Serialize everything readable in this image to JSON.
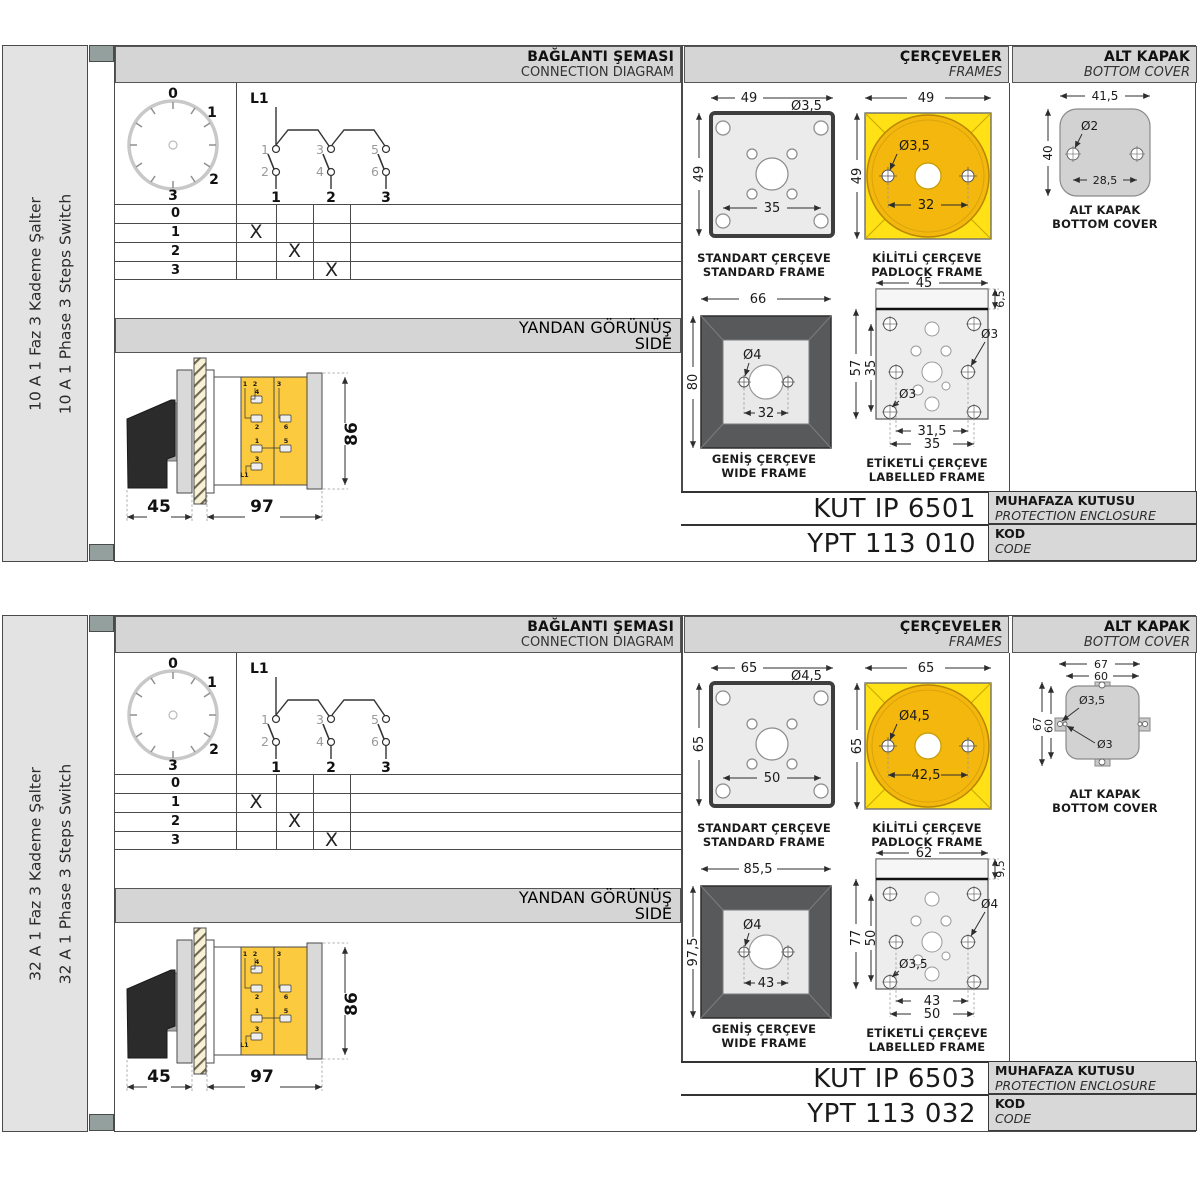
{
  "products": [
    {
      "sidebar": {
        "label_tr": "10 A 1 Faz 3 Kademe Şalter",
        "label_en": "10 A 1 Phase 3 Steps Switch"
      },
      "headers": {
        "connection_tr": "BAĞLANTI ŞEMASI",
        "connection_en": "CONNECTION DIAGRAM",
        "frames_tr": "ÇERÇEVELER",
        "frames_en": "FRAMES",
        "cover_tr": "ALT KAPAK",
        "cover_en": "BOTTOM COVER",
        "side_tr": "YANDAN GÖRÜNÜŞ",
        "side_en": "SIDE"
      },
      "dial": {
        "p0": "0",
        "p1": "1",
        "p2": "2",
        "p3": "3"
      },
      "schematic": {
        "feed": "L1",
        "in1": "1",
        "in2": "2",
        "in3": "3",
        "in4": "4",
        "in5": "5",
        "in6": "6",
        "out1": "1",
        "out2": "2",
        "out3": "3"
      },
      "table": {
        "rows": [
          "0",
          "1",
          "2",
          "3"
        ],
        "mark": "X"
      },
      "frames": {
        "standard": {
          "title_tr": "STANDART ÇERÇEVE",
          "title_en": "STANDARD FRAME",
          "dim_w": "49",
          "dim_h": "49",
          "hole": "Ø3,5",
          "pitch": "35"
        },
        "padlock": {
          "title_tr": "KİLİTLİ ÇERÇEVE",
          "title_en": "PADLOCK FRAME",
          "dim_w": "49",
          "dim_h": "49",
          "hole": "Ø3,5",
          "pitch": "32"
        },
        "wide": {
          "title_tr": "GENİŞ ÇERÇEVE",
          "title_en": "WIDE FRAME",
          "dim_w": "66",
          "dim_h": "80",
          "hole": "Ø4",
          "pitch": "32"
        },
        "labelled": {
          "title_tr": "ETİKETLİ ÇERÇEVE",
          "title_en": "LABELLED FRAME",
          "dim_w": "45",
          "band": "6,5",
          "dim_h": "57",
          "inner": "35",
          "hole_right": "Ø3",
          "hole_inner": "Ø3",
          "pitch1": "31,5",
          "pitch2": "35"
        }
      },
      "cover": {
        "variant": "simple",
        "title_tr": "ALT KAPAK",
        "title_en": "BOTTOM COVER",
        "dim_w": "41,5",
        "dim_h": "40",
        "hole": "Ø2",
        "pitch": "28,5"
      },
      "side_view": {
        "dim_front": "45",
        "dim_body": "97",
        "dim_height": "86",
        "t_top1": "1",
        "t_top2": "2",
        "t_top3": "3",
        "t4": "4",
        "t2": "2",
        "t1": "1",
        "t3": "3",
        "t6": "6",
        "t5": "5",
        "feed": "L1"
      },
      "codes": {
        "enclosure": "KUT IP 6501",
        "enclosure_label_tr": "MUHAFAZA KUTUSU",
        "enclosure_label_en": "PROTECTION ENCLOSURE",
        "code": "YPT 113 010",
        "code_label_tr": "KOD",
        "code_label_en": "CODE"
      }
    },
    {
      "sidebar": {
        "label_tr": "32 A 1 Faz 3 Kademe Şalter",
        "label_en": "32 A 1 Phase 3 Steps Switch"
      },
      "headers": {
        "connection_tr": "BAĞLANTI ŞEMASI",
        "connection_en": "CONNECTION DIAGRAM",
        "frames_tr": "ÇERÇEVELER",
        "frames_en": "FRAMES",
        "cover_tr": "ALT KAPAK",
        "cover_en": "BOTTOM COVER",
        "side_tr": "YANDAN GÖRÜNÜŞ",
        "side_en": "SIDE"
      },
      "dial": {
        "p0": "0",
        "p1": "1",
        "p2": "2",
        "p3": "3"
      },
      "schematic": {
        "feed": "L1",
        "in1": "1",
        "in2": "2",
        "in3": "3",
        "in4": "4",
        "in5": "5",
        "in6": "6",
        "out1": "1",
        "out2": "2",
        "out3": "3"
      },
      "table": {
        "rows": [
          "0",
          "1",
          "2",
          "3"
        ],
        "mark": "X"
      },
      "frames": {
        "standard": {
          "title_tr": "STANDART ÇERÇEVE",
          "title_en": "STANDARD FRAME",
          "dim_w": "65",
          "dim_h": "65",
          "hole": "Ø4,5",
          "pitch": "50"
        },
        "padlock": {
          "title_tr": "KİLİTLİ ÇERÇEVE",
          "title_en": "PADLOCK FRAME",
          "dim_w": "65",
          "dim_h": "65",
          "hole": "Ø4,5",
          "pitch": "42,5"
        },
        "wide": {
          "title_tr": "GENİŞ ÇERÇEVE",
          "title_en": "WIDE FRAME",
          "dim_w": "85,5",
          "dim_h": "97,5",
          "hole": "Ø4",
          "pitch": "43"
        },
        "labelled": {
          "title_tr": "ETİKETLİ ÇERÇEVE",
          "title_en": "LABELLED FRAME",
          "dim_w": "62",
          "band": "9,5",
          "dim_h": "77",
          "inner": "50",
          "hole_right": "Ø4",
          "hole_inner": "Ø3,5",
          "pitch1": "43",
          "pitch2": "50"
        }
      },
      "cover": {
        "variant": "tabs",
        "title_tr": "ALT KAPAK",
        "title_en": "BOTTOM COVER",
        "dim_w_outer": "67",
        "dim_w_inner": "60",
        "dim_h_outer": "67",
        "dim_h_inner": "60",
        "hole_top": "Ø3,5",
        "hole_side": "Ø3"
      },
      "side_view": {
        "dim_front": "45",
        "dim_body": "97",
        "dim_height": "86",
        "t_top1": "1",
        "t_top2": "2",
        "t_top3": "3",
        "t4": "4",
        "t2": "2",
        "t1": "1",
        "t3": "3",
        "t6": "6",
        "t5": "5",
        "feed": "L1"
      },
      "codes": {
        "enclosure": "KUT IP 6503",
        "enclosure_label_tr": "MUHAFAZA KUTUSU",
        "enclosure_label_en": "PROTECTION ENCLOSURE",
        "code": "YPT 113 032",
        "code_label_tr": "KOD",
        "code_label_en": "CODE"
      }
    }
  ]
}
